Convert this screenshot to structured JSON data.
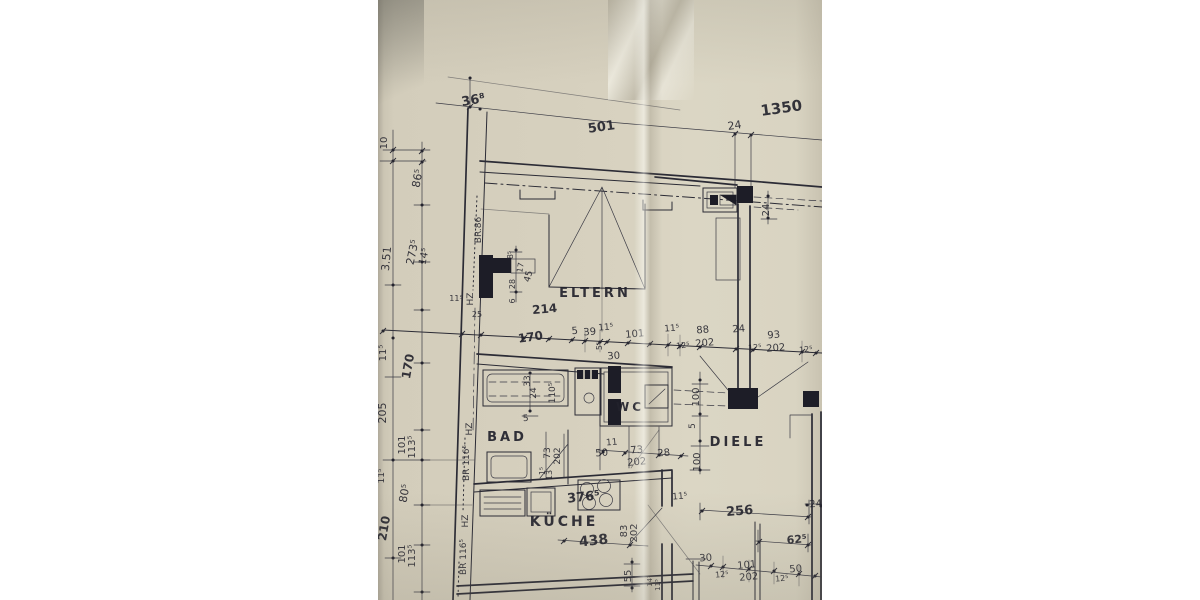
{
  "colors": {
    "paper": "#d6d0be",
    "ink": "#26262f"
  },
  "rooms": {
    "eltern": "ELTERN",
    "bad": "BAD",
    "wc": "WC",
    "diele": "DIELE",
    "kueche": "KÜCHE"
  },
  "dims": [
    "36⁸",
    "501",
    "1350",
    "24",
    "10",
    "86⁵",
    "BR.86",
    "24",
    "8⁵",
    "17",
    "45",
    "28",
    "6",
    "273⁵",
    "14⁵",
    "3.51",
    "214",
    "170",
    "5",
    "39",
    "11⁵",
    "101",
    "11⁵",
    "12⁵",
    "88",
    "202",
    "24",
    "12⁵",
    "93",
    "202",
    "12⁵",
    "5⁵",
    "30",
    "11⁵",
    "HZ",
    "25",
    "11⁵",
    "170",
    "205",
    "101",
    "113⁵",
    "11⁵",
    "80⁵",
    "210",
    "101",
    "113⁵",
    "HZ",
    "BR 116⁵",
    "HZ",
    "BR 116⁵",
    "33",
    "24",
    "110⁵",
    "5",
    "73",
    "202",
    "1⁵",
    "13",
    "11",
    "50",
    "73",
    "202",
    "28",
    "100",
    "5",
    "100",
    "376⁵",
    "438",
    "83",
    "202",
    "55",
    "14⁵",
    "11⁵",
    "11⁵",
    "256",
    "24",
    "62⁵",
    "30",
    "101",
    "202",
    "12⁵",
    "12⁵",
    "50"
  ]
}
